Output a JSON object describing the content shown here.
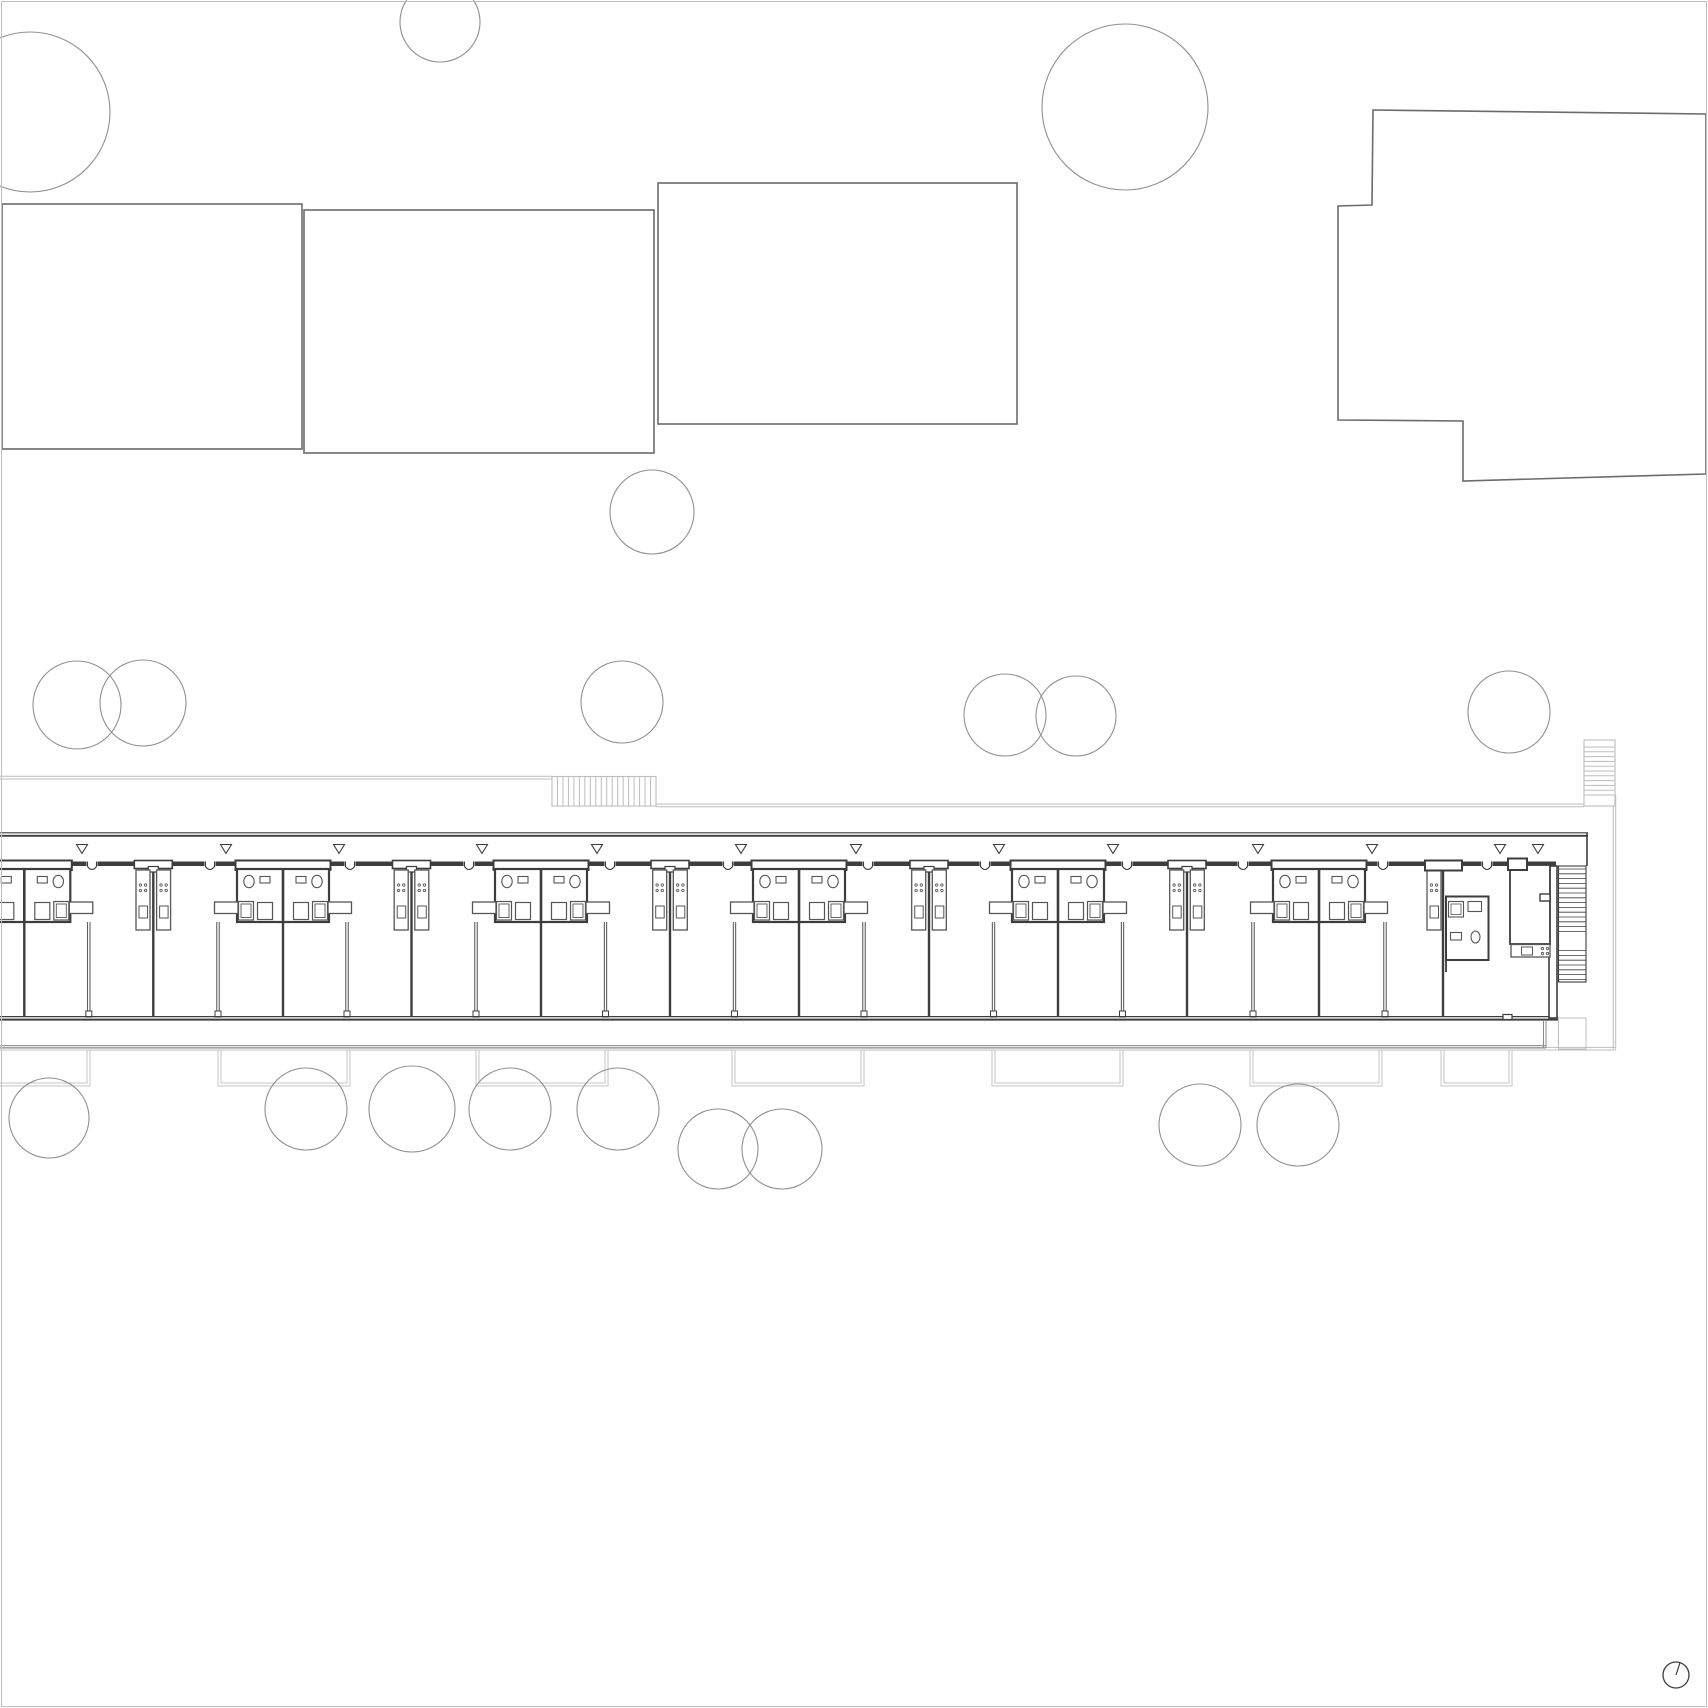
{
  "meta": {
    "drawing_type": "architectural-site-floor-plan",
    "canvas": {
      "w": 1708,
      "h": 1708
    }
  },
  "colors": {
    "background": "#ffffff",
    "site_gray": "#bdbdbd",
    "patio_gray": "#c4c4c4",
    "neighbor": "#6b6b6b",
    "tree": "#909090",
    "wall": "#3d3d3d",
    "fixture": "#565656",
    "balcony": "#8a8a8a",
    "frame": "#bfbfbf"
  },
  "neighbors": {
    "rects": [
      [
        2,
        204,
        300,
        245
      ],
      [
        304,
        210,
        350,
        243
      ],
      [
        658,
        183,
        359,
        241
      ]
    ],
    "poly": [
      [
        1373,
        110
      ],
      [
        1706,
        114
      ],
      [
        1706,
        474
      ],
      [
        1463,
        481
      ],
      [
        1463,
        421
      ],
      [
        1338,
        420
      ],
      [
        1338,
        206
      ],
      [
        1372,
        205
      ]
    ]
  },
  "trees": [
    [
      30,
      112,
      80
    ],
    [
      440,
      22,
      40
    ],
    [
      1125,
      107,
      83
    ],
    [
      652,
      512,
      42
    ],
    [
      77,
      705,
      44
    ],
    [
      143,
      703,
      43
    ],
    [
      622,
      702,
      41
    ],
    [
      1005,
      715,
      41
    ],
    [
      1076,
      716,
      40
    ],
    [
      1509,
      712,
      41
    ],
    [
      49,
      1118,
      40
    ],
    [
      306,
      1109,
      41
    ],
    [
      412,
      1109,
      43
    ],
    [
      510,
      1109,
      41
    ],
    [
      618,
      1109,
      41
    ],
    [
      718,
      1149,
      40
    ],
    [
      782,
      1149,
      40
    ],
    [
      1200,
      1125,
      41
    ],
    [
      1298,
      1125,
      41
    ]
  ],
  "site": {
    "gallery_line_left": {
      "x1": 0,
      "x2": 552,
      "y": 776.3,
      "gap": 2.7
    },
    "gallery_line_right": {
      "x1": 656,
      "x2": 1584,
      "y": 804.0,
      "gap": 2.7
    },
    "bottom_line": {
      "x1": 0,
      "x2": 1616,
      "y": 1047.4,
      "gap": 2.6
    },
    "east_vertical": {
      "x": 1613.3,
      "gap": 2.4,
      "y1": 795,
      "y2": 1049
    },
    "stair_top": {
      "x": 552,
      "y": 776.5,
      "w": 104,
      "h": 29.5,
      "treads": 19
    },
    "stair_ne": {
      "x": 1584,
      "y": 740,
      "w": 31,
      "h": 66,
      "t1": 747,
      "t2": 795,
      "treads": 10
    },
    "patios": {
      "y": 1050,
      "h": 36,
      "inset": 3,
      "spans": [
        [
          -20,
          90
        ],
        [
          218,
          350
        ],
        [
          476,
          608
        ],
        [
          732,
          864
        ],
        [
          992,
          1123
        ],
        [
          1250,
          1382
        ],
        [
          1441,
          1512
        ]
      ]
    },
    "frame_inset": 1.5
  },
  "building": {
    "north_wall": {
      "y1": 832.8,
      "y2": 835.8,
      "x1": 0,
      "x2": 1588
    },
    "unit_wall": {
      "y": 863.8,
      "w": 4.5,
      "x1": 0,
      "x2": 1556
    },
    "south_wall": {
      "y1": 1016.6,
      "y2": 1019.6,
      "x1": 0,
      "x2": 1558
    },
    "balcony": {
      "yb1": 1045.6,
      "yb2": 1048,
      "x2": 1546,
      "ytop": 1020
    },
    "triangles": {
      "y": 844.5,
      "h": 9,
      "hw": 5.5,
      "xs": [
        82,
        226,
        339,
        482,
        597,
        741,
        856,
        999,
        1113,
        1258,
        1372,
        1500,
        1538
      ]
    },
    "doors": {
      "hw": 5.5,
      "xs": [
        92,
        210,
        350,
        469,
        610,
        728,
        868,
        985,
        1127,
        1243,
        1383,
        1487
      ]
    },
    "party_walls": {
      "y1": 866,
      "y2": 1016,
      "xs": [
        24.3,
        153.3,
        283,
        411.5,
        541,
        670,
        799,
        929,
        1058,
        1187,
        1319,
        1443
      ]
    },
    "mullions": {
      "y1": 922,
      "y2": 1012,
      "xs": [
        88.8,
        218,
        347,
        476,
        605.5,
        734.5,
        864,
        993.5,
        1122.5,
        1253,
        1385
      ]
    },
    "bath_walls": [
      24.3,
      283,
      541,
      799,
      1058,
      1319
    ],
    "kitchen_walls": [
      153.3,
      411.5,
      670,
      929,
      1187
    ],
    "kitchen_single": 1443,
    "east": {
      "wall": [
        1549,
        866,
        8,
        152
      ],
      "stair": {
        "x": 1558.5,
        "y": 866,
        "w": 27.5,
        "h": 116,
        "l1": 934,
        "l2": 946,
        "step": 4.8
      },
      "lower": [
        1558.5,
        1018,
        27.5,
        31
      ],
      "core": {
        "x": 1510,
        "y": 865,
        "w": 40,
        "h": 79,
        "notch": [
          1540,
          894,
          10,
          7
        ]
      },
      "counter": {
        "x": 1511,
        "y": 944.5,
        "w": 39,
        "h": 12.5,
        "sink": [
          1521.5,
          947,
          11,
          8
        ],
        "dots": [
          1542.5,
          948.5
        ]
      },
      "bath": {
        "x": 1446,
        "y": 896.5,
        "w": 42.5,
        "h": 63.5
      },
      "blocks": [
        [
          1425,
          860.5,
          37,
          10
        ],
        [
          1508,
          858.5,
          19,
          11.5
        ]
      ],
      "tick": [
        1503,
        1014.5,
        9,
        5
      ]
    },
    "north_arrow": {
      "cx": 1676,
      "cy": 1675,
      "r": 13
    }
  }
}
